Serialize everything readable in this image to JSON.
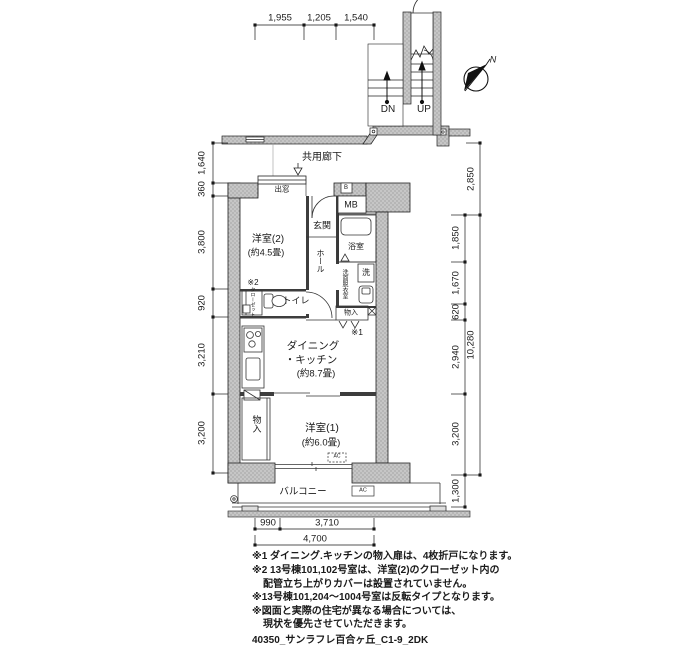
{
  "title": "40350_サンラフレ百合ヶ丘_C1-9_2DK",
  "compass": {
    "north": "N"
  },
  "corridor": "共用廊下",
  "stairs": {
    "down": "DN",
    "up": "UP"
  },
  "labels": {
    "bay_window": "出窓",
    "shaft": "B",
    "meter_box": "MB",
    "entrance": "玄関",
    "bath": "浴室",
    "laundry": "洗",
    "washroom": "洗面脱衣室",
    "hall": "ホール",
    "bedroom2": "洋室(2)",
    "bedroom2_size": "(約4.5畳)",
    "note2_mark": "※2",
    "closet": "クローゼット",
    "toilet": "トイレ",
    "storage_dk": "物入",
    "note1_mark": "※1",
    "dk_line1": "ダイニング",
    "dk_line2": "・キッチン",
    "dk_size": "(約8.7畳)",
    "storage_b1": "物入",
    "bedroom1": "洋室(1)",
    "bedroom1_size": "(約6.0畳)",
    "balcony": "バルコニー",
    "ac": "AC",
    "ac2": "AC"
  },
  "dims": {
    "top": [
      "1,955",
      "1,205",
      "1,540"
    ],
    "left": [
      "1,640",
      "360",
      "3,800",
      "920",
      "3,210",
      "3,200"
    ],
    "right": [
      "2,850",
      "1,850",
      "1,670",
      "620",
      "2,940",
      "3,200",
      "1,300"
    ],
    "right_total": "10,280",
    "bottom": [
      "990",
      "3,710"
    ],
    "bottom_total": "4,700"
  },
  "notes": {
    "line1": "※1 ダイニング.キッチンの物入扉は、4枚折戸になります。",
    "line2": "※2 13号棟101,102号室は、洋室(2)のクローゼット内の",
    "line3": "配管立ち上がりカバーは設置されていません。",
    "line4": "※13号棟101,204〜1004号室は反転タイプとなります。",
    "line5": "※図面と実際の住宅が異なる場合については、",
    "line6": "現状を優先させていただきます。"
  },
  "colors": {
    "wall_fill": "#c6c6c6",
    "line": "#1a1a1a",
    "bg": "#ffffff"
  }
}
